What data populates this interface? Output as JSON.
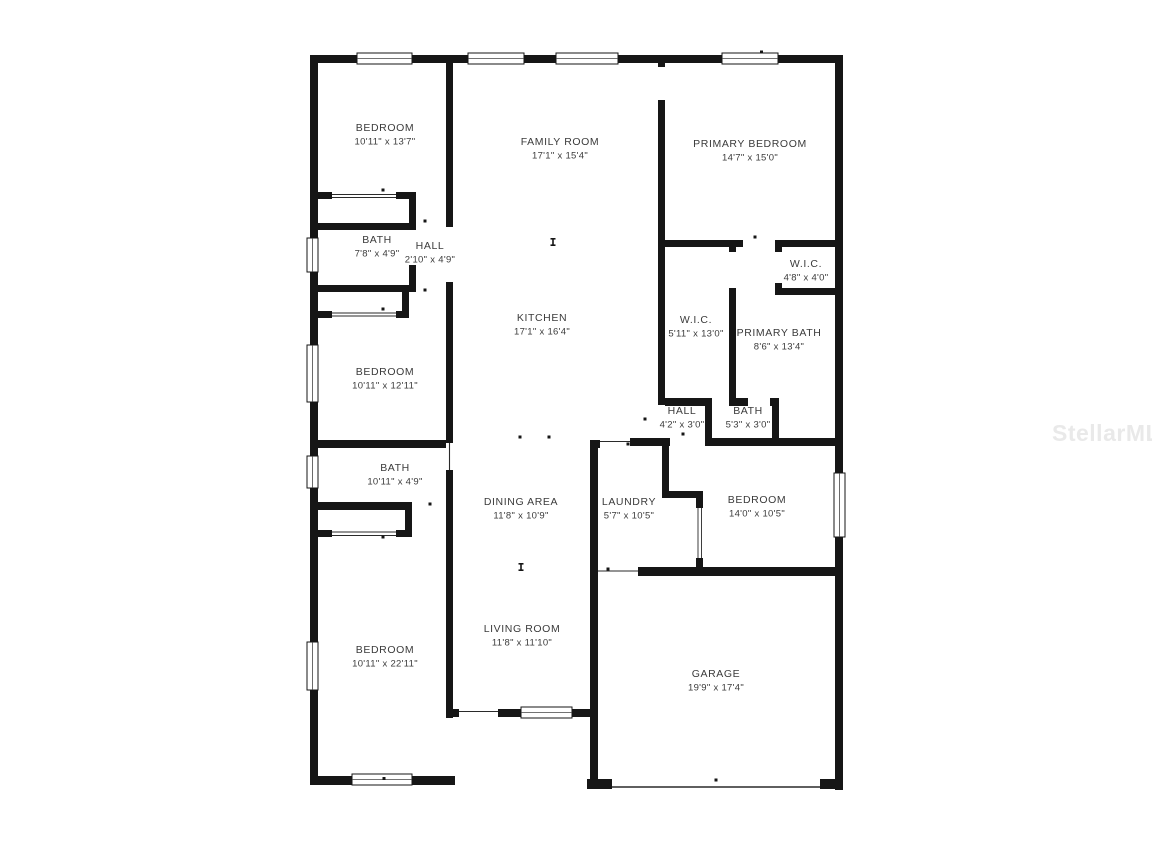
{
  "watermark": {
    "text": "StellarMLS"
  },
  "plan": {
    "wall_color": "#161616",
    "label_color": "#3b3b3b",
    "watermark_color": "#e9e9e9",
    "background": "#ffffff",
    "rooms": {
      "bedroom_top_left": {
        "name": "BEDROOM",
        "dims": "10'11\" x 13'7\""
      },
      "family_room": {
        "name": "FAMILY ROOM",
        "dims": "17'1\" x 15'4\""
      },
      "primary_bedroom": {
        "name": "PRIMARY BEDROOM",
        "dims": "14'7\" x 15'0\""
      },
      "bath_1": {
        "name": "BATH",
        "dims": "7'8\" x 4'9\""
      },
      "hall_1": {
        "name": "HALL",
        "dims": "2'10\" x 4'9\""
      },
      "wic_small": {
        "name": "W.I.C.",
        "dims": "4'8\" x 4'0\""
      },
      "kitchen": {
        "name": "KITCHEN",
        "dims": "17'1\" x 16'4\""
      },
      "wic_large": {
        "name": "W.I.C.",
        "dims": "5'11\" x 13'0\""
      },
      "primary_bath": {
        "name": "PRIMARY BATH",
        "dims": "8'6\" x 13'4\""
      },
      "bedroom_mid_left": {
        "name": "BEDROOM",
        "dims": "10'11\" x 12'11\""
      },
      "hall_2": {
        "name": "HALL",
        "dims": "4'2\" x 3'0\""
      },
      "bath_3": {
        "name": "BATH",
        "dims": "5'3\" x 3'0\""
      },
      "bath_2": {
        "name": "BATH",
        "dims": "10'11\" x 4'9\""
      },
      "dining_area": {
        "name": "DINING AREA",
        "dims": "11'8\" x 10'9\""
      },
      "laundry": {
        "name": "LAUNDRY",
        "dims": "5'7\" x 10'5\""
      },
      "bedroom_right": {
        "name": "BEDROOM",
        "dims": "14'0\" x 10'5\""
      },
      "bedroom_bottom_left": {
        "name": "BEDROOM",
        "dims": "10'11\" x 22'11\""
      },
      "living_room": {
        "name": "LIVING ROOM",
        "dims": "11'8\" x 11'10\""
      },
      "garage": {
        "name": "GARAGE",
        "dims": "19'9\" x 17'4\""
      }
    }
  }
}
